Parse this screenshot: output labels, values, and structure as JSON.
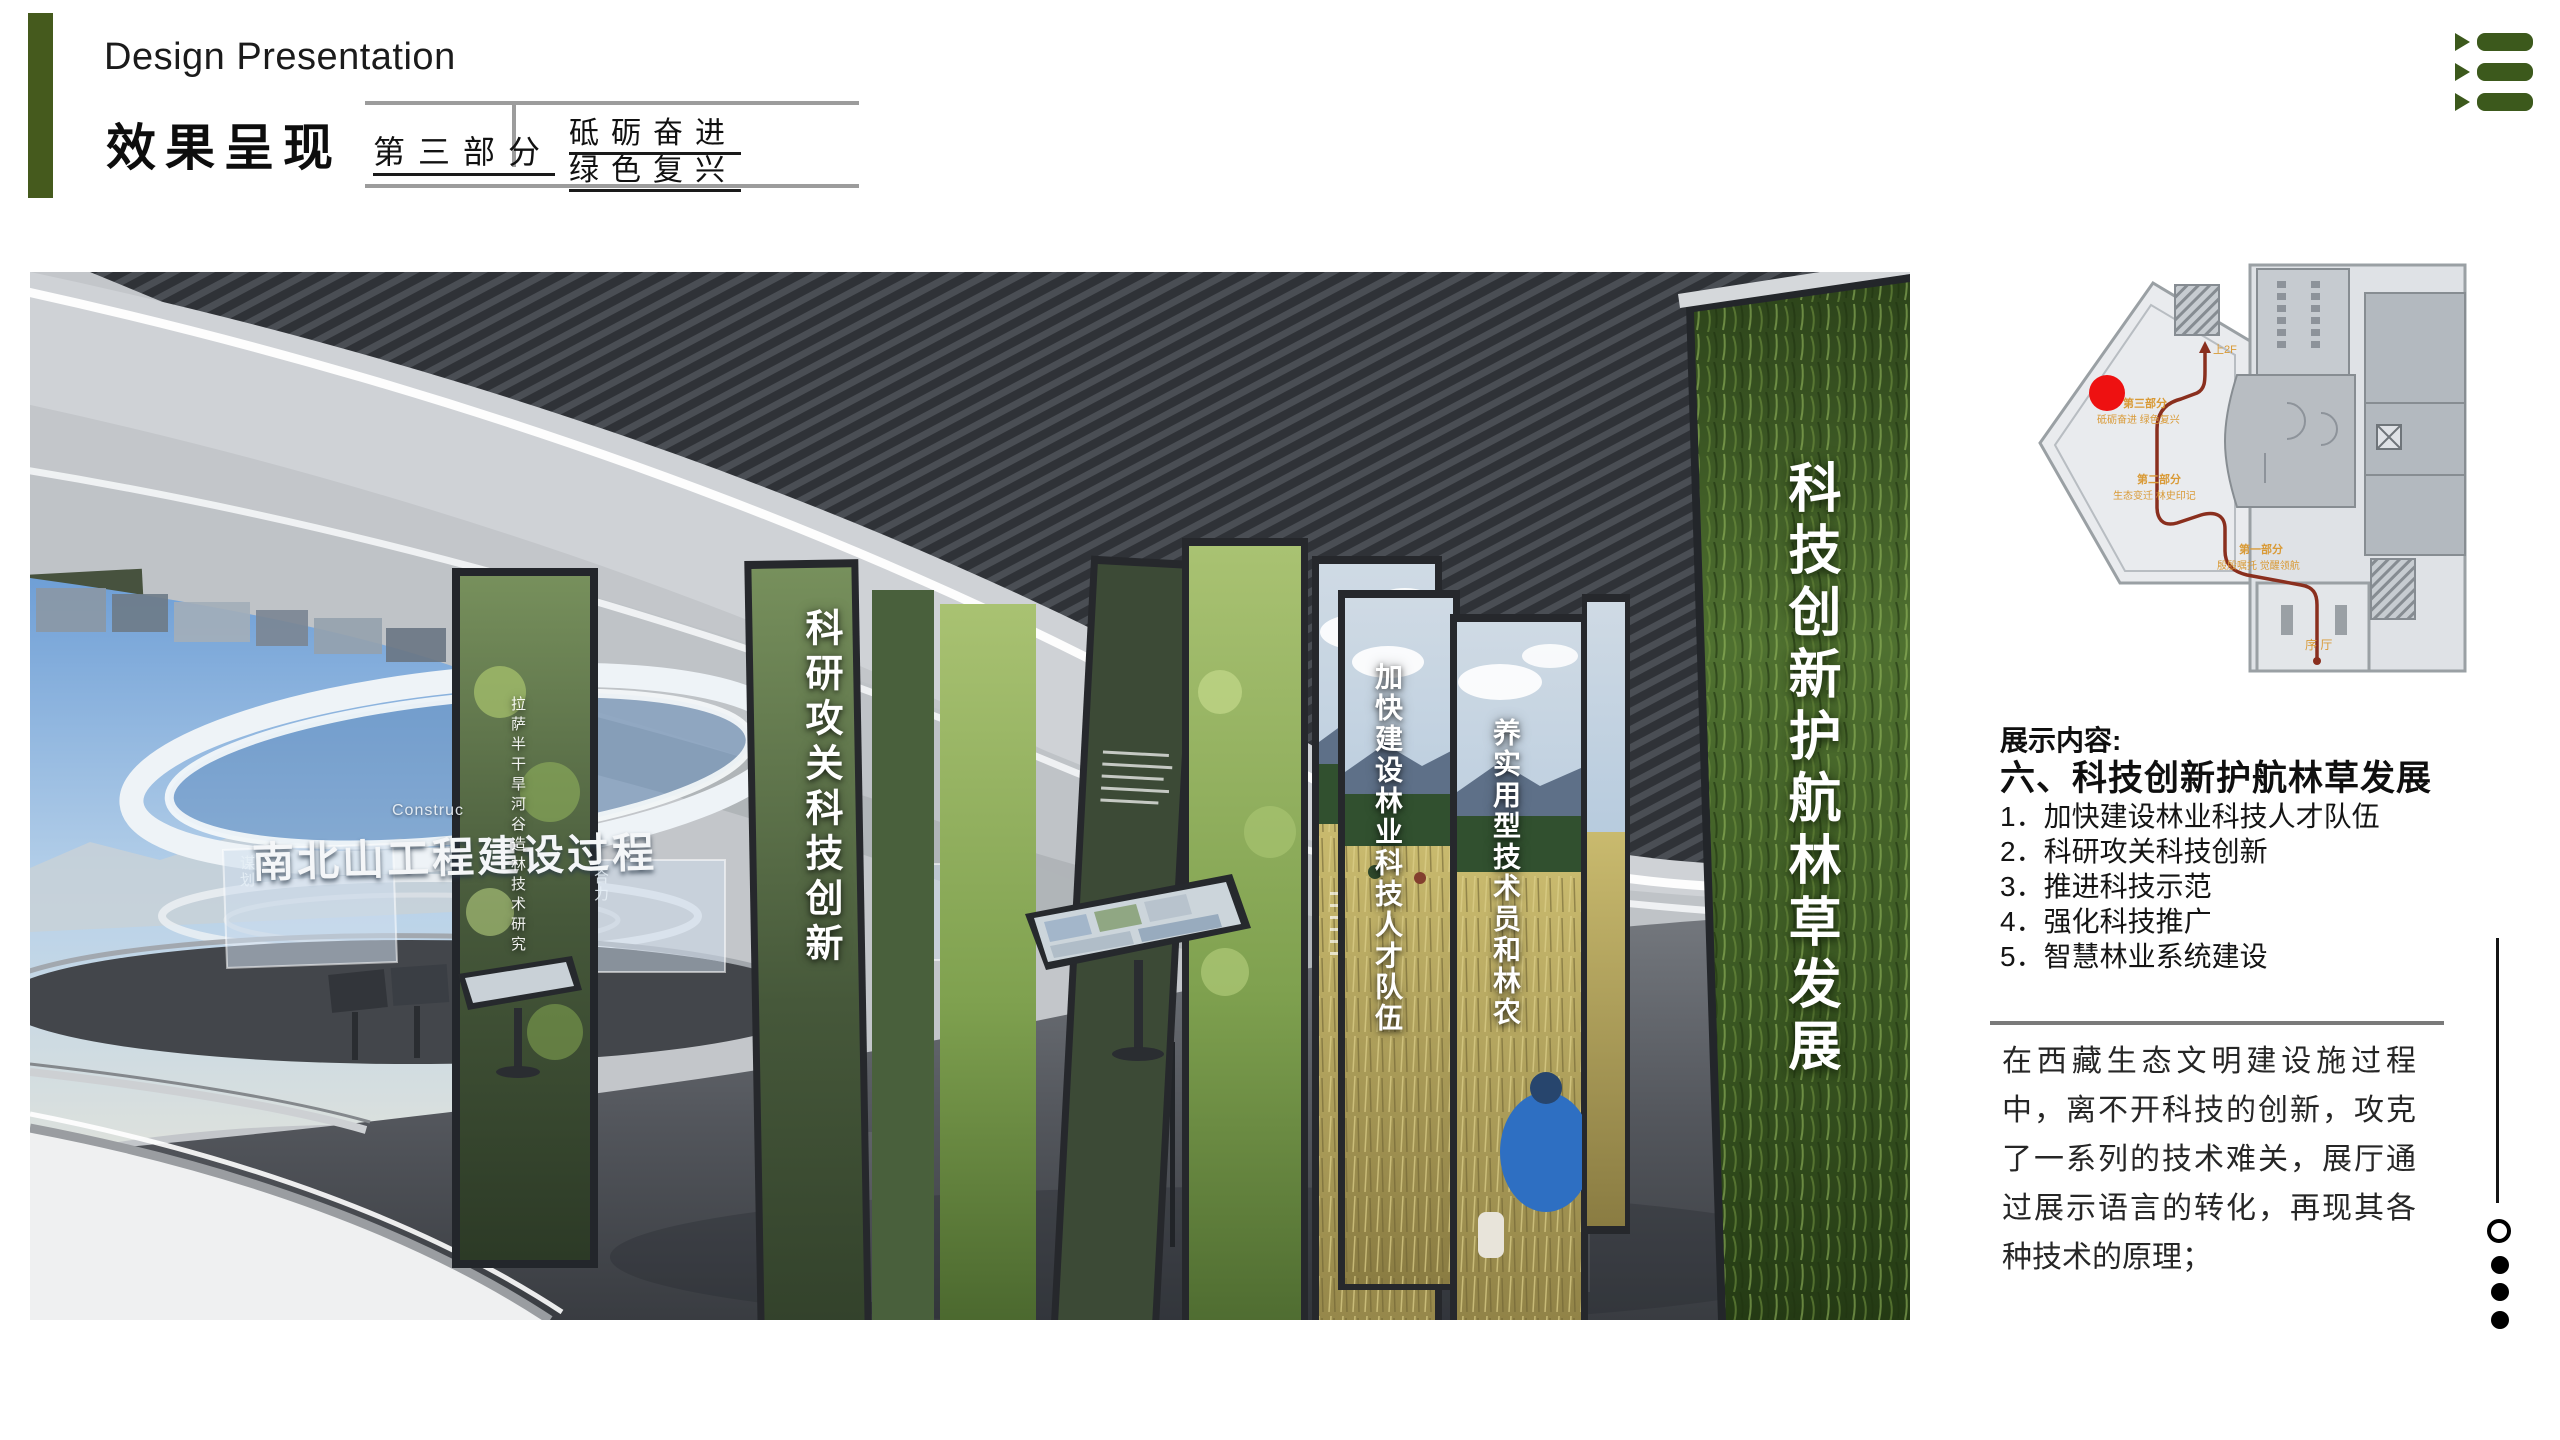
{
  "header": {
    "title_en": "Design Presentation",
    "title_zh": "效果呈现",
    "part_label": "第三部分",
    "slogan_line1": "砥砺奋进",
    "slogan_line2": "绿色复兴",
    "accent_color": "#455a1d",
    "rule_color": "#9c9c9c"
  },
  "toc_icon": {
    "name": "list-menu-icon",
    "color": "#3c591c"
  },
  "render": {
    "screen_title": "南北山工程建设过程",
    "screen_title_en": "Construc",
    "texts": {
      "keyan": "科研攻关科技创新",
      "lasa": "拉萨半干旱河谷造林技术研究",
      "jiakuai": "加快建设林业科技人才队伍",
      "yang": "养实用型技术员和林农",
      "grass_wall": "科技创新护航林草发展"
    },
    "captions": {
      "c1": "谋划",
      "c2": "合力"
    }
  },
  "floor_plan": {
    "labels": {
      "up2f": "上2F",
      "part3": "第三部分",
      "part3_sub": "砥砺奋进 绿色复兴",
      "part2": "第二部分",
      "part2_sub": "生态变迁 林史印记",
      "part1": "第一部分",
      "part1_sub": "殷殷嘱托 觉醒领航",
      "lobby": "序 厅"
    },
    "marker_color": "#ee1111",
    "route_color": "#8a2f1e",
    "label_color": "#d99a36"
  },
  "content": {
    "heading": "展示内容:",
    "section_title": "六、科技创新护航林草发展",
    "items": [
      "1．加快建设林业科技人才队伍",
      "2．科研攻关科技创新",
      "3．推进科技示范",
      "4．强化科技推广",
      "5．智慧林业系统建设"
    ],
    "paragraph": "在西藏生态文明建设施过程中，离不开科技的创新，攻克了一系列的技术难关，展厅通过展示语言的转化，再现其各种技术的原理；"
  }
}
